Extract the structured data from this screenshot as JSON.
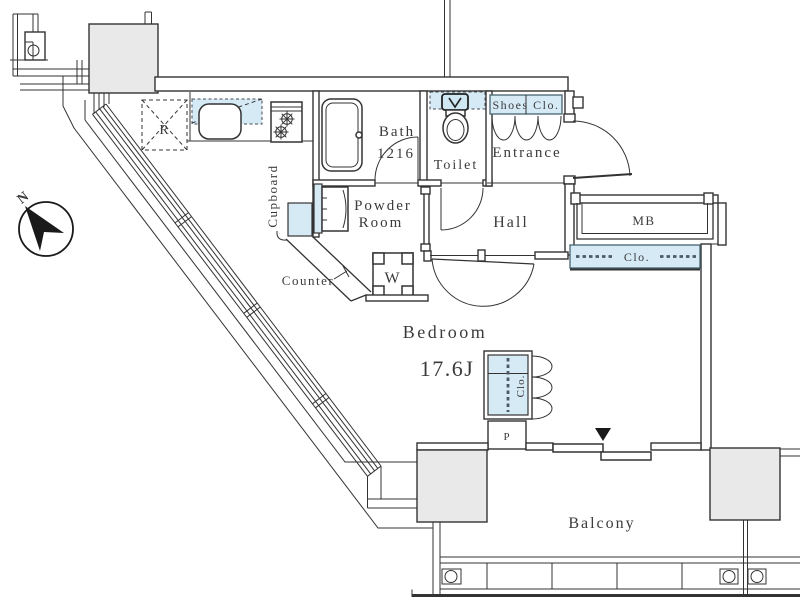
{
  "plan": {
    "compass": {
      "north_label": "N"
    },
    "kitchen": {
      "refrigerator_label": "R",
      "cupboard_label": "Cupboard",
      "counter_label": "Counter"
    },
    "bath": {
      "name": "Bath",
      "size": "1216"
    },
    "toilet": {
      "label": "Toilet"
    },
    "entrance": {
      "label": "Entrance",
      "shoes_closet_label": "Shoes Clo."
    },
    "hall": {
      "label": "Hall"
    },
    "meter_box": {
      "label": "MB"
    },
    "hall_closet": {
      "label": "Clo."
    },
    "powder_room": {
      "name_line1": "Powder",
      "name_line2": "Room",
      "washer_label": "W"
    },
    "bedroom": {
      "name": "Bedroom",
      "size": "17.6J",
      "closet_label": "Clo.",
      "pipe_space_label": "P"
    },
    "balcony": {
      "label": "Balcony"
    },
    "colors": {
      "wall_line": "#333333",
      "fixture_blue": "#d6eaf6",
      "column_gray": "#e9e9e9",
      "text": "#3b3b3b"
    }
  }
}
